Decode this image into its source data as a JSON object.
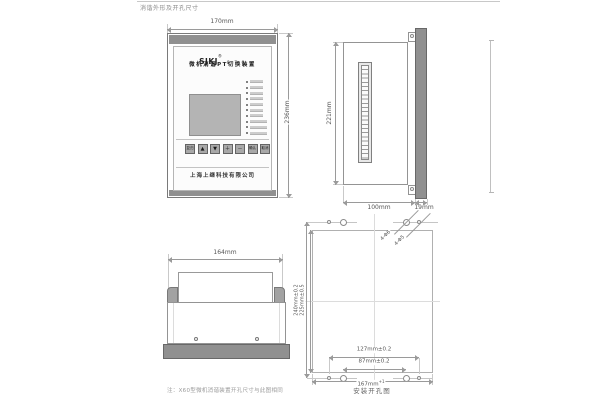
{
  "page": {
    "title": "消谐外形及开孔尺寸",
    "note": "注：X60型微机消谐装置开孔尺寸与此图相同"
  },
  "front_view": {
    "dim_width": "170mm",
    "dim_height": "236mm",
    "logo": "SJKJ",
    "logo_reg": "®",
    "model": "8 7 0",
    "device_name": "微机消谐PT切换装置",
    "company": "上海上继科技有限公司",
    "buttons": [
      "复归",
      "▲",
      "▼",
      "＋",
      "－",
      "确认",
      "取消"
    ],
    "led_count": 10
  },
  "side_view": {
    "dim_height": "221mm",
    "dim_depth": "100mm",
    "dim_panel_thickness": "19mm"
  },
  "bottom_view": {
    "dim_width": "164mm"
  },
  "hole_diagram": {
    "caption": "安装开孔图",
    "dim_height_outer": "240mm±0.2",
    "dim_height_inner": "225mm±0.5",
    "dim_width_outer": "127mm±0.2",
    "dim_width_inner": "87mm±0.2",
    "dim_width_full": "167mm",
    "dim_width_full_tol": "+1",
    "hole_label_large": "4-Φ6",
    "hole_label_small": "4-Φ5"
  },
  "colors": {
    "panel_dark": "#909090",
    "lcd_screen": "#b4b4b4",
    "drawing_line": "#9a9a9a"
  }
}
